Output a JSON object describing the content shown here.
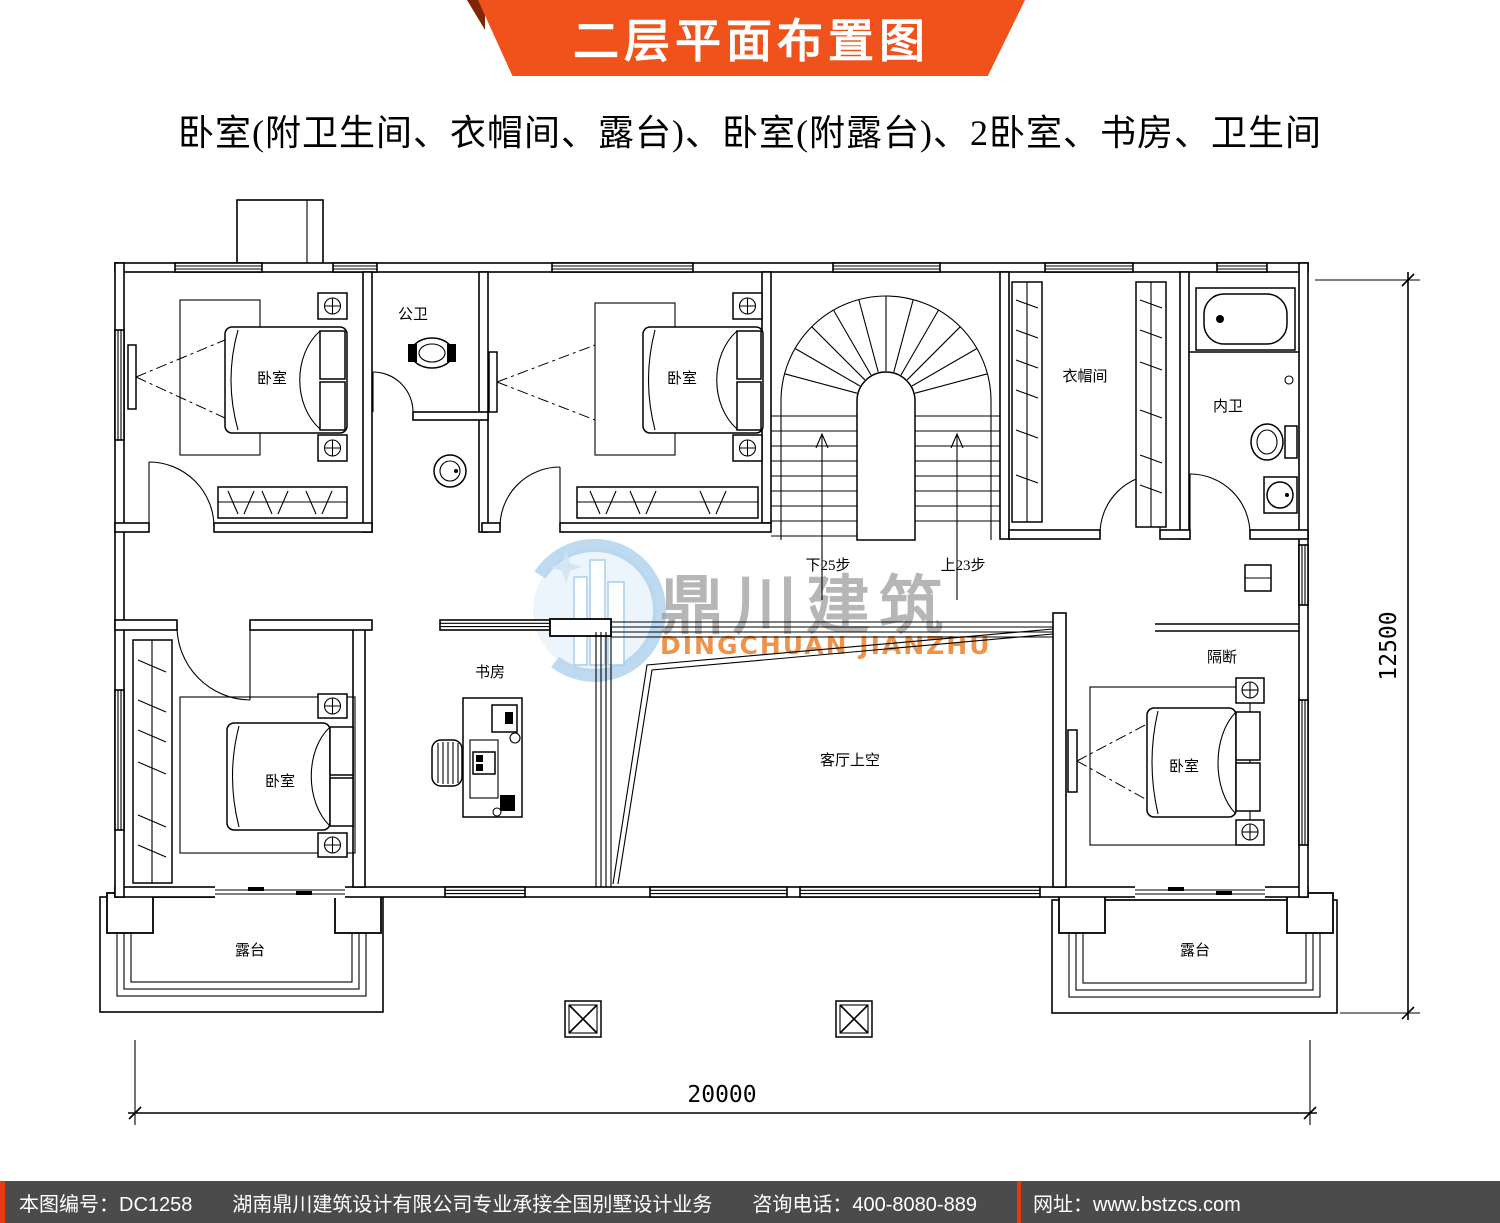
{
  "banner": {
    "title": "二层平面布置图"
  },
  "subtitle": "卧室(附卫生间、衣帽间、露台)、卧室(附露台)、2卧室、书房、卫生间",
  "plan": {
    "labels": {
      "bedroom_tl": "卧室",
      "bath_public": "公卫",
      "bedroom_tm": "卧室",
      "cloakroom": "衣帽间",
      "bath_ensuite": "内卫",
      "bedroom_bl": "卧室",
      "study": "书房",
      "living_void": "客厅上空",
      "partition": "隔断",
      "bedroom_br": "卧室",
      "terrace_left": "露台",
      "terrace_right": "露台",
      "stair_down": "下25步",
      "stair_up": "上23步"
    },
    "dimensions": {
      "total_width": "20000",
      "total_height": "12500"
    }
  },
  "watermark": {
    "name_cn": "鼎川建筑",
    "name_en": "DINGCHUAN JIANZHU"
  },
  "footer": {
    "drawing_no": "本图编号：DC1258",
    "company": "湖南鼎川建筑设计有限公司专业承接全国别墅设计业务",
    "phone": "咨询电话：400-8080-889",
    "website": "网址：www.bstzcs.com"
  },
  "colors": {
    "banner_orange": "#f1511b",
    "banner_fold": "#7e2606",
    "footer_bg": "#4b4b4b",
    "footer_accent": "#e8380d",
    "watermark_gray": "#9e9e9e",
    "watermark_orange": "#e8822f",
    "logo_blue": "#a8cdec"
  }
}
